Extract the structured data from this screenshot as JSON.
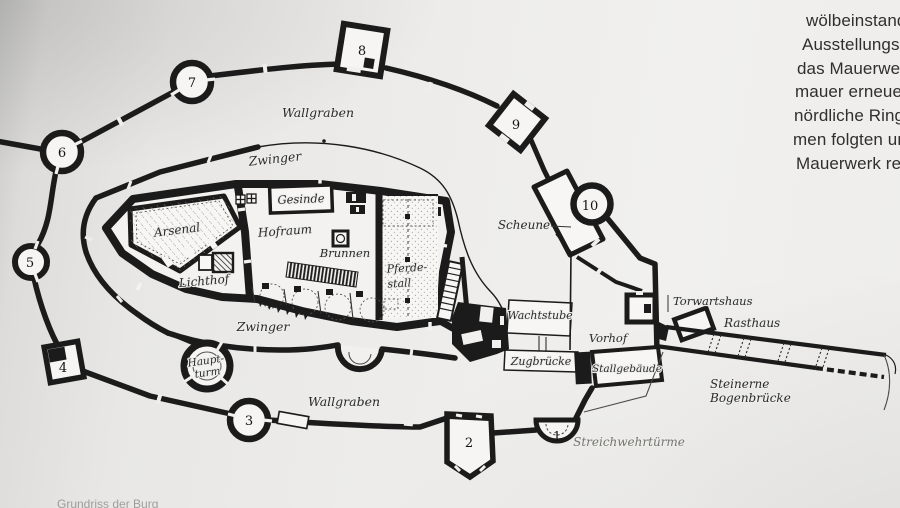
{
  "article": {
    "lines": [
      "wölbeinstandse",
      "Ausstellungsrau",
      "das Mauerwerk",
      "mauer erneuert,",
      "nördliche Ringm",
      "men folgten und",
      "Mauerwerk repa"
    ]
  },
  "plan": {
    "labels": {
      "wallgraben_top": "Wallgraben",
      "zwinger_top": "Zwinger",
      "gesinde": "Gesinde",
      "arsenal": "Arsenal",
      "hofraum": "Hofraum",
      "brunnen": "Brunnen",
      "lichthof": "Lichthof",
      "pferdestall_1": "Pferde-",
      "pferdestall_2": "stall",
      "zwinger_bottom": "Zwinger",
      "hauptturm_1": "Haupt-",
      "hauptturm_2": "turm",
      "wallgraben_bottom": "Wallgraben",
      "scheune": "Scheune",
      "wachtstube": "Wachtstube",
      "vorhof": "Vorhof",
      "zugbruecke": "Zugbrücke",
      "stallgebaeude": "Stallgebäude",
      "torwartshaus": "Torwartshaus",
      "rasthaus": "Rasthaus",
      "bogenbruecke_1": "Steinerne",
      "bogenbruecke_2": "Bogenbrücke",
      "streichwehrtuerme": "Streichwehrtürme"
    },
    "towers": {
      "t1": "1",
      "t2": "2",
      "t3": "3",
      "t4": "4",
      "t5": "5",
      "t6": "6",
      "t7": "7",
      "t8": "8",
      "t9": "9",
      "t10": "10"
    }
  },
  "caption": {
    "fragment": "Grundriss der Burg"
  },
  "colors": {
    "ink": "#1b1b1b",
    "label_ink": "#2a2a2a",
    "muted_label": "#75756d",
    "paper": "#f6f5f3"
  }
}
